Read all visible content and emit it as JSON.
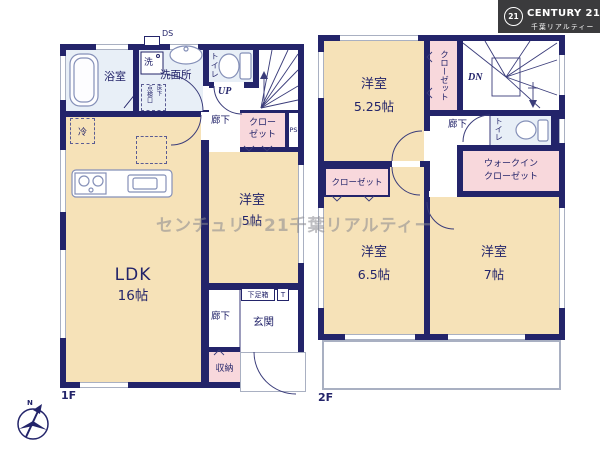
{
  "logo": {
    "badge": "21",
    "brand": "CENTURY 21",
    "company": "千葉リアルティー"
  },
  "watermark": "センチュリー21千葉リアルティー",
  "compass": {
    "north": "N"
  },
  "floor1": {
    "label": "1F",
    "duct": "DS",
    "bathroom": "浴室",
    "washer": "洗",
    "washroom": "洗面所",
    "hatch_main": "点検口",
    "hatch_sub": "床下",
    "toilet": "トイレ",
    "stairs_up": "UP",
    "hallway_upper": "廊下",
    "closet_line1": "クロー",
    "closet_line2": "ゼット",
    "pipe_space": "PS",
    "fridge": "冷",
    "ldk": "LDK",
    "ldk_size": "16帖",
    "bedroom5": "洋室",
    "bedroom5_size": "5帖",
    "hallway_lower": "廊下",
    "shoe_box": "下足箱",
    "shoe_t": "T",
    "entrance": "玄関",
    "storage": "収納"
  },
  "floor2": {
    "label": "2F",
    "bedroom525": "洋室",
    "bedroom525_size": "5.25帖",
    "closet_vertical": "クローゼット",
    "stairs_down": "DN",
    "hallway": "廊下",
    "toilet": "トイレ",
    "wic_line1": "ウォークイン",
    "wic_line2": "クローゼット",
    "closet2": "クローゼット",
    "bedroom65": "洋室",
    "bedroom65_size": "6.5帖",
    "bedroom7": "洋室",
    "bedroom7_size": "7帖"
  }
}
